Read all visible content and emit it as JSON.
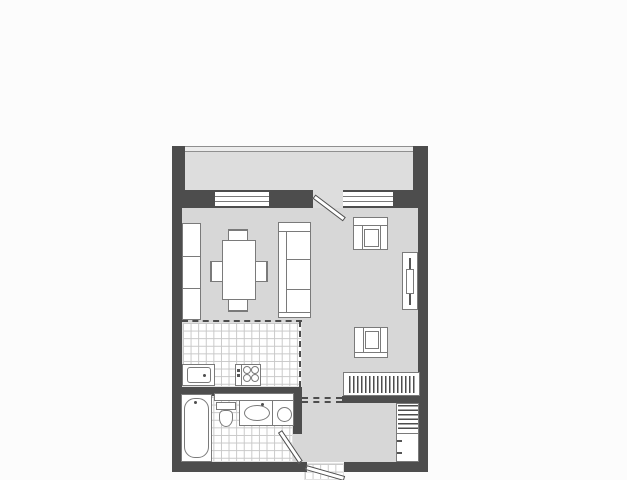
{
  "image_type": "apartment-floor-plan-drawing",
  "visible_text": [],
  "colors": {
    "background": "#fcfcfc",
    "wall": "#4d4d4d",
    "room_floor": "#d7d7d7",
    "balcony_floor": "#dddddd",
    "tile_grid": "#c8c8c8",
    "fixture_outline": "#7a7a7a",
    "fixture_fill": "#ffffff"
  },
  "plan": {
    "areas": [
      {
        "name": "balcony",
        "floor": "plain"
      },
      {
        "name": "living-room",
        "floor": "plain"
      },
      {
        "name": "kitchen",
        "floor": "tiled"
      },
      {
        "name": "bathroom",
        "floor": "tiled"
      },
      {
        "name": "hallway",
        "floor": "plain"
      },
      {
        "name": "entry-landing",
        "floor": "tiled"
      }
    ],
    "openings": [
      {
        "name": "window-left",
        "wall": "north"
      },
      {
        "name": "window-right",
        "wall": "north"
      },
      {
        "name": "balcony-door",
        "wall": "north",
        "swing": "into-room"
      },
      {
        "name": "bathroom-door",
        "wall": "bathroom-side",
        "swing": "into-bathroom"
      },
      {
        "name": "entrance-door",
        "wall": "south",
        "swing": "outward"
      }
    ],
    "furniture": [
      {
        "name": "shelf-unit",
        "area": "living-room",
        "sections": 3
      },
      {
        "name": "dining-table",
        "area": "living-room"
      },
      {
        "name": "dining-chairs",
        "area": "living-room",
        "count": 4
      },
      {
        "name": "sofa",
        "area": "living-room",
        "seat_cushions": 3
      },
      {
        "name": "armchair-north",
        "area": "living-room"
      },
      {
        "name": "armchair-south",
        "area": "living-room"
      },
      {
        "name": "tv-stand-with-tv",
        "area": "living-room"
      },
      {
        "name": "kitchen-sink",
        "area": "kitchen"
      },
      {
        "name": "cooktop",
        "area": "kitchen",
        "burners": 4
      },
      {
        "name": "bathtub",
        "area": "bathroom"
      },
      {
        "name": "wall-shelf",
        "area": "bathroom"
      },
      {
        "name": "toilet",
        "area": "bathroom"
      },
      {
        "name": "vanity-with-oval-basin",
        "area": "bathroom"
      },
      {
        "name": "round-basin",
        "area": "bathroom"
      },
      {
        "name": "wardrobe-with-hangers",
        "area": "hallway"
      },
      {
        "name": "hall-cabinet-with-shelves",
        "area": "hallway"
      }
    ]
  }
}
